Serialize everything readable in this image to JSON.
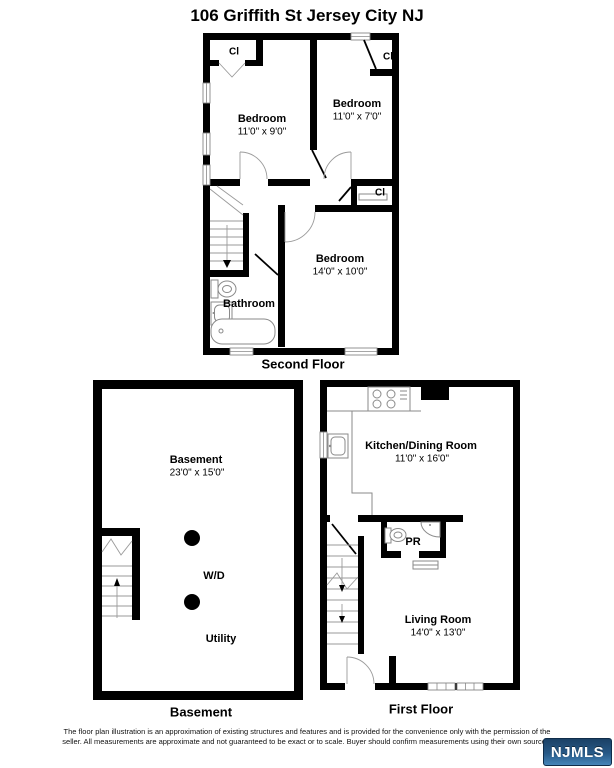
{
  "title": "106 Griffith St Jersey City NJ",
  "floors": {
    "second": {
      "label": "Second Floor",
      "closet_label": "Cl",
      "rooms": [
        {
          "name": "Bedroom",
          "dims": "11'0\" x 9'0\""
        },
        {
          "name": "Bedroom",
          "dims": "11'0\" x 7'0\""
        },
        {
          "name": "Bedroom",
          "dims": "14'0\" x 10'0\""
        },
        {
          "name": "Bathroom",
          "dims": ""
        }
      ]
    },
    "first": {
      "label": "First Floor",
      "rooms": [
        {
          "name": "Kitchen/Dining Room",
          "dims": "11'0\" x 16'0\""
        },
        {
          "name": "PR",
          "dims": ""
        },
        {
          "name": "Living Room",
          "dims": "14'0\" x 13'0\""
        }
      ]
    },
    "basement": {
      "label": "Basement",
      "rooms": [
        {
          "name": "Basement",
          "dims": "23'0\" x 15'0\""
        },
        {
          "name": "W/D",
          "dims": ""
        },
        {
          "name": "Utility",
          "dims": ""
        }
      ]
    }
  },
  "disclaimer": "The floor plan illustration is an approximation of existing structures and features and is provided for the convenience only with the permission of the seller. All measurements are approximate and not guaranteed to be exact or to scale. Buyer should confirm measurements using their own sources.",
  "logo": {
    "text": "NJMLS"
  },
  "colors": {
    "wall": "#000000",
    "fixture": "#8a8a8a",
    "logo_top": "#1b4166",
    "logo_bottom": "#4585b8",
    "logo_text": "#ffffff"
  }
}
